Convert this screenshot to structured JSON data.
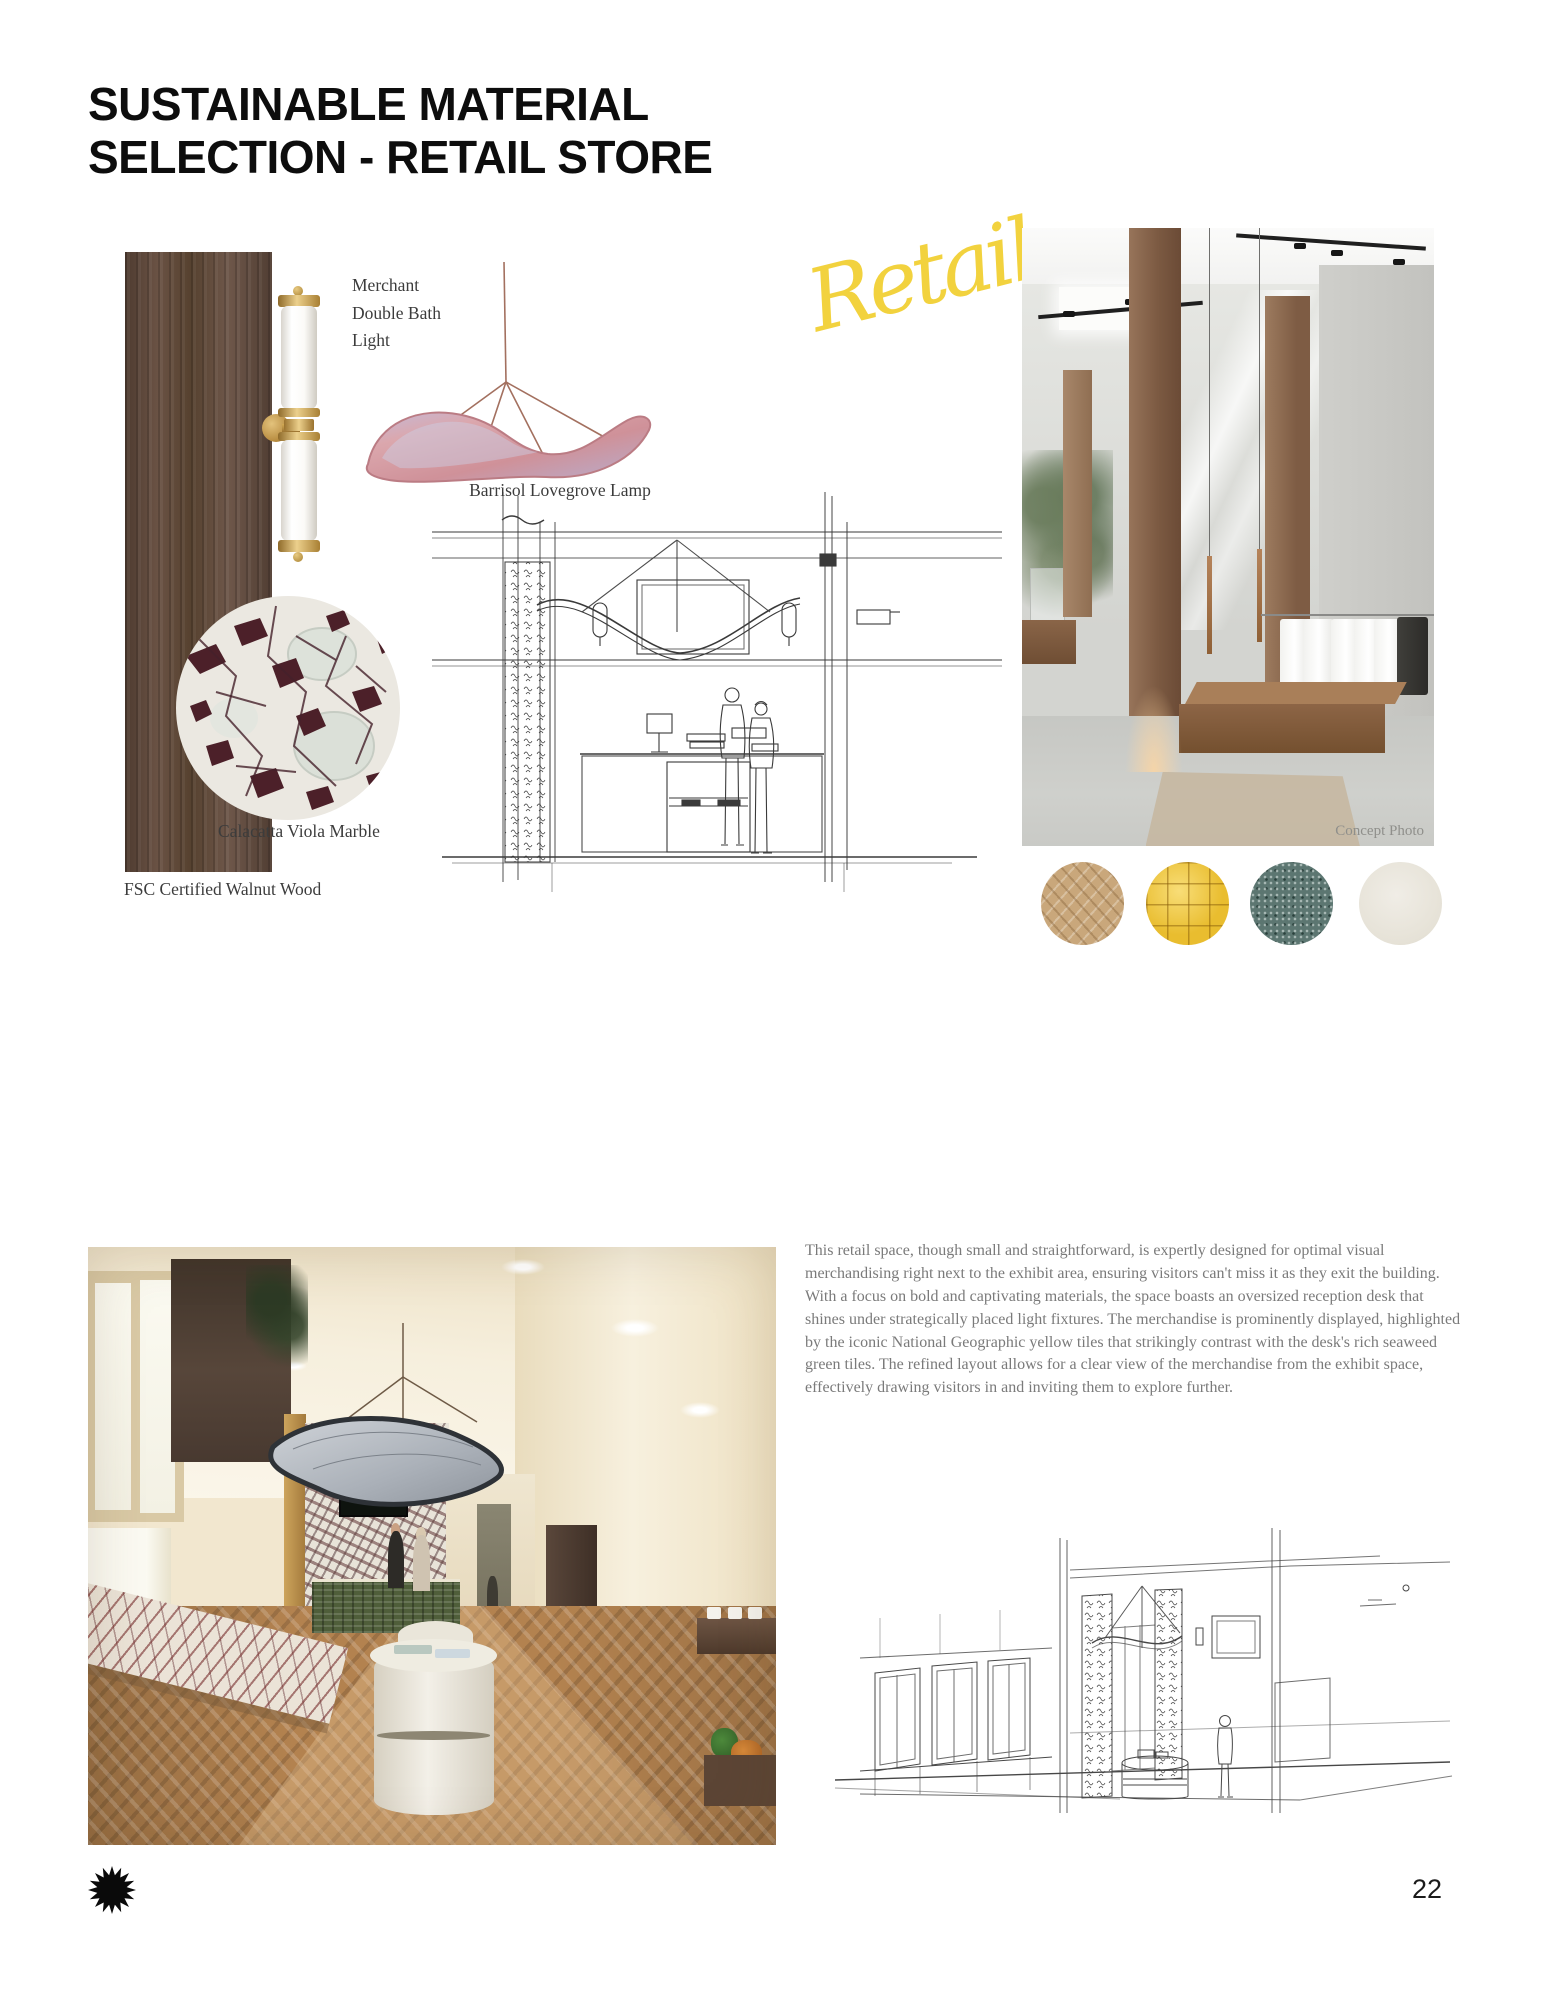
{
  "page": {
    "title_line1": "SUSTAINABLE MATERIAL",
    "title_line2": "SELECTION - RETAIL STORE",
    "number": "22"
  },
  "moodboard": {
    "script_word": "Retail",
    "accent_yellow": "#f2d23e",
    "labels": {
      "wall_light": "Merchant\nDouble Bath\nLight",
      "pendant_lamp": "Barrisol Lovegrove Lamp",
      "marble": "Calacatta Viola Marble",
      "wood": "FSC Certified Walnut Wood"
    },
    "concept_photo_caption": "Concept Photo",
    "material_swatches": [
      {
        "name": "herringbone oak wood floor",
        "color": "#c9a77b"
      },
      {
        "name": "national geographic yellow tiles",
        "color": "#e9bd2f"
      },
      {
        "name": "seaweed green tile",
        "color": "#5c7671"
      },
      {
        "name": "off-white plaster",
        "color": "#e9e6dd"
      }
    ]
  },
  "description": {
    "paragraph": "This retail space, though small and straightforward, is expertly designed for optimal visual merchandising right next to the exhibit area, ensuring visitors can't miss it as they exit the building. With a focus on bold and captivating materials, the space boasts an oversized reception desk that shines under strategically placed light fixtures. The merchandise is prominently displayed, highlighted by the iconic National Geographic yellow tiles that strikingly contrast with the desk's rich seaweed green tiles. The refined layout allows for a clear view of the merchandise from the exhibit space, effectively drawing visitors in and inviting them to explore further."
  }
}
